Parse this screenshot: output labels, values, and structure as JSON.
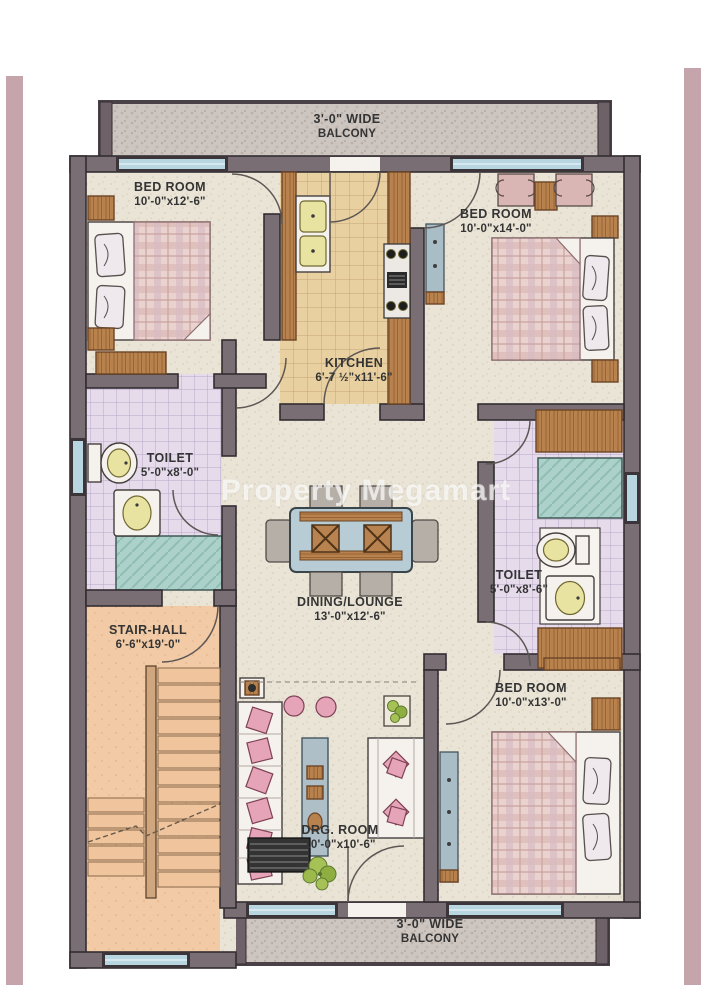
{
  "watermark": "Property Megamart",
  "colors": {
    "page_border_strip": "#c6a4ac",
    "wall": "#796e74",
    "wall_outline": "#332d32",
    "floor_cream": "#eae4d6",
    "floor_kitchen": "#e9d0a0",
    "floor_toilet": "#e6dbeb",
    "floor_shower": "#abd1ca",
    "floor_stair": "#f2cba6",
    "floor_balcony": "#cdc5bf",
    "window_glass": "#b8d6e0",
    "wood": "#b8824e",
    "cushion_pink": "#e5a4b8",
    "fixture_yellow": "#e9e3a2",
    "table_blue": "#b7ccd5"
  },
  "rooms": {
    "balcony_top": {
      "label": "3'-0\" WIDE",
      "sublabel": "BALCONY"
    },
    "bedroom_top_left": {
      "label": "BED ROOM",
      "dims": "10'-0\"x12'-6\""
    },
    "kitchen": {
      "label": "KITCHEN",
      "dims": "6'-7 ½\"x11'-6\""
    },
    "bedroom_top_right": {
      "label": "BED ROOM",
      "dims": "10'-0\"x14'-0\""
    },
    "toilet_left": {
      "label": "TOILET",
      "dims": "5'-0\"x8'-0\""
    },
    "dining_lounge": {
      "label": "DINING/LOUNGE",
      "dims": "13'-0\"x12'-6\""
    },
    "toilet_right": {
      "label": "TOILET",
      "dims": "5'-0\"x8'-6\""
    },
    "stair_hall": {
      "label": "STAIR-HALL",
      "dims": "6'-6\"x19'-0\""
    },
    "drawing_room": {
      "label": "DRG. ROOM",
      "dims": "10'-0\"x10'-6\""
    },
    "bedroom_bottom_right": {
      "label": "BED ROOM",
      "dims": "10'-0\"x13'-0\""
    },
    "balcony_bottom": {
      "label": "3'-0\" WIDE",
      "sublabel": "BALCONY"
    }
  }
}
